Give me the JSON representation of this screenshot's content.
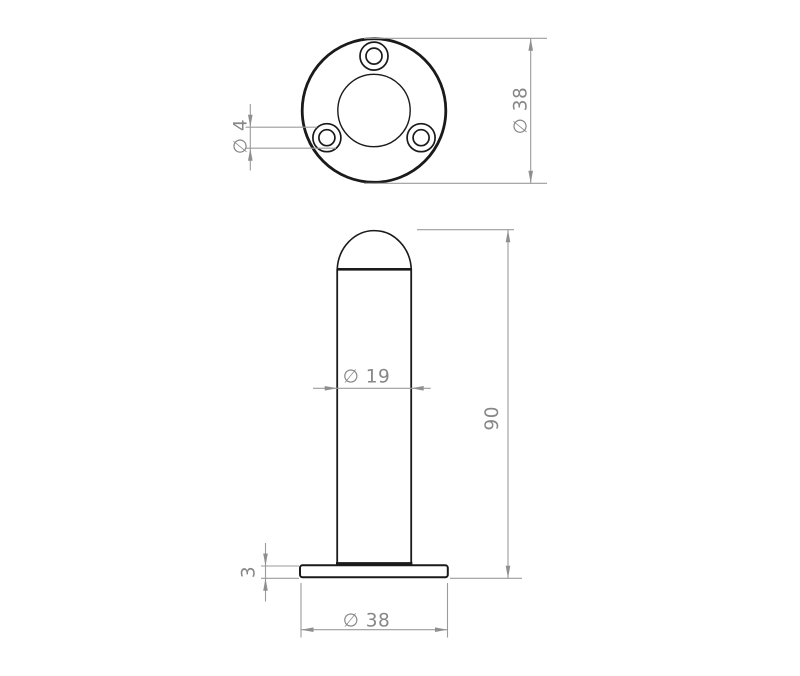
{
  "canvas": {
    "width": 800,
    "height": 676,
    "background": "#ffffff"
  },
  "colors": {
    "model_line": "#1a1a1a",
    "dimension_line": "#9b9b9b",
    "dimension_text": "#878787",
    "arrow_fill": "#8f8f8f"
  },
  "label_font_size": 18.5,
  "views": [
    {
      "name": "top-view",
      "shapes": [
        {
          "name": "flange-outer-circle",
          "type": "circle",
          "cx": 374,
          "cy": 110.5,
          "r": 71.8,
          "sw": 2.8
        },
        {
          "name": "post-silhouette-circle",
          "type": "circle",
          "cx": 374,
          "cy": 110.5,
          "r": 36.2,
          "sw": 1.4
        },
        {
          "name": "bolt-hole-top-counterbore",
          "type": "circle",
          "cx": 374,
          "cy": 56.1,
          "r": 14,
          "sw": 1.7
        },
        {
          "name": "bolt-hole-top-bore",
          "type": "circle",
          "cx": 374,
          "cy": 56.1,
          "r": 8,
          "sw": 1.7
        },
        {
          "name": "bolt-hole-left-counterbore",
          "type": "circle",
          "cx": 326.9,
          "cy": 137.7,
          "r": 14,
          "sw": 1.7
        },
        {
          "name": "bolt-hole-left-bore",
          "type": "circle",
          "cx": 326.9,
          "cy": 137.7,
          "r": 8,
          "sw": 1.7
        },
        {
          "name": "bolt-hole-right-counterbore",
          "type": "circle",
          "cx": 421.1,
          "cy": 137.7,
          "r": 14,
          "sw": 1.7
        },
        {
          "name": "bolt-hole-right-bore",
          "type": "circle",
          "cx": 421.1,
          "cy": 137.7,
          "r": 8,
          "sw": 1.7
        }
      ]
    },
    {
      "name": "front-view",
      "shapes": [
        {
          "name": "dome-cap-arc",
          "type": "path",
          "d": "M 337.2 269.3 A 37.1 40.8 0 0 1 411.3 269.3",
          "sw": 1.6
        },
        {
          "name": "dome-base-edge",
          "type": "line",
          "x1": 336.5,
          "y1": 269.3,
          "x2": 412,
          "y2": 269.3,
          "sw": 2.6
        },
        {
          "name": "post-left-wall",
          "type": "line",
          "x1": 337.2,
          "y1": 269.3,
          "x2": 337.2,
          "y2": 563.6,
          "sw": 1.8
        },
        {
          "name": "post-right-wall",
          "type": "line",
          "x1": 411.2,
          "y1": 269.3,
          "x2": 411.2,
          "y2": 563.6,
          "sw": 1.8
        },
        {
          "name": "post-base-joint-edge",
          "type": "line",
          "x1": 336,
          "y1": 563.8,
          "x2": 412.4,
          "y2": 563.8,
          "sw": 3.4
        },
        {
          "name": "base-plate-outline",
          "type": "rect",
          "x": 300,
          "y": 565.3,
          "w": 147.8,
          "h": 12,
          "rx": 2.5,
          "sw": 2
        }
      ]
    }
  ],
  "dimensions": [
    {
      "name": "dim-flange-diameter-top-view",
      "label": "∅ 38",
      "label_pos": [
        526.5,
        110.5
      ],
      "label_rotate": -90,
      "ext_lines": [
        [
          364,
          38.3,
          547,
          38.3
        ],
        [
          364,
          183.3,
          547,
          183.3
        ]
      ],
      "dim_lines": [
        [
          530.7,
          38.3,
          530.7,
          183.3
        ]
      ],
      "arrows": [
        {
          "x": 530.7,
          "y": 38.3,
          "dir": "up"
        },
        {
          "x": 530.7,
          "y": 183.3,
          "dir": "down"
        }
      ]
    },
    {
      "name": "dim-bolt-hole-diameter",
      "label": "∅ 4",
      "label_pos": [
        246.5,
        136.5
      ],
      "label_rotate": -90,
      "ext_lines": [
        [
          245.5,
          127.2,
          317,
          127.2
        ],
        [
          245.5,
          148.2,
          336,
          148.2
        ]
      ],
      "dim_lines": [
        [
          250.3,
          104,
          250.3,
          170.5
        ]
      ],
      "arrows": [
        {
          "x": 250.3,
          "y": 127.2,
          "dir": "down"
        },
        {
          "x": 250.3,
          "y": 148.2,
          "dir": "up"
        }
      ]
    },
    {
      "name": "dim-post-diameter",
      "label": "∅ 19",
      "label_pos": [
        366.5,
        382.5
      ],
      "label_rotate": 0,
      "ext_lines": [],
      "dim_lines": [
        [
          313,
          388.3,
          430.7,
          388.3
        ]
      ],
      "arrows": [
        {
          "x": 337.2,
          "y": 388.3,
          "dir": "right"
        },
        {
          "x": 411.2,
          "y": 388.3,
          "dir": "left"
        }
      ]
    },
    {
      "name": "dim-overall-height",
      "label": "90",
      "label_pos": [
        498,
        418.3
      ],
      "label_rotate": -90,
      "ext_lines": [
        [
          417,
          229.7,
          514,
          229.7
        ],
        [
          450,
          578.3,
          522,
          578.3
        ]
      ],
      "dim_lines": [
        [
          508,
          229.7,
          508,
          578.3
        ]
      ],
      "arrows": [
        {
          "x": 508,
          "y": 229.7,
          "dir": "up"
        },
        {
          "x": 508,
          "y": 578.3,
          "dir": "down"
        }
      ]
    },
    {
      "name": "dim-base-thickness",
      "label": "3",
      "label_pos": [
        254.5,
        572
      ],
      "label_rotate": -90,
      "ext_lines": [
        [
          261,
          566,
          299,
          566
        ],
        [
          261,
          578.3,
          299,
          578.3
        ]
      ],
      "dim_lines": [
        [
          265.5,
          543,
          265.5,
          601.5
        ]
      ],
      "arrows": [
        {
          "x": 265.5,
          "y": 566,
          "dir": "down"
        },
        {
          "x": 265.5,
          "y": 578.3,
          "dir": "up"
        }
      ]
    },
    {
      "name": "dim-base-diameter",
      "label": "∅ 38",
      "label_pos": [
        366.5,
        626.5
      ],
      "label_rotate": 0,
      "ext_lines": [
        [
          301,
          583,
          301,
          637.5
        ],
        [
          447.5,
          583,
          447.5,
          637.5
        ]
      ],
      "dim_lines": [
        [
          301,
          629.7,
          447.5,
          629.7
        ]
      ],
      "arrows": [
        {
          "x": 301,
          "y": 629.7,
          "dir": "left"
        },
        {
          "x": 447.5,
          "y": 629.7,
          "dir": "right"
        }
      ]
    }
  ]
}
